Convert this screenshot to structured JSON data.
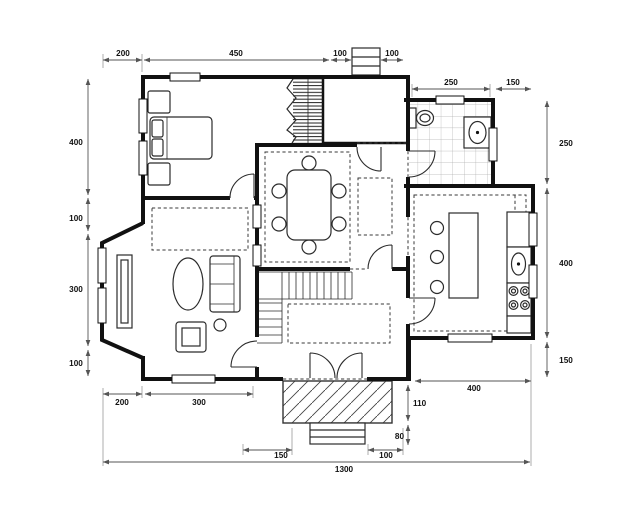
{
  "colors": {
    "background": "#ffffff",
    "walls": "#111111",
    "furniture_lines": "#2b2b2b",
    "dimension_lines": "#555555",
    "dimension_text": "#111111"
  },
  "dims": {
    "top": [
      "200",
      "450",
      "100",
      "100"
    ],
    "upper_right": [
      "250",
      "150"
    ],
    "right": [
      "250",
      "400",
      "150"
    ],
    "left": [
      "400",
      "100",
      "300",
      "100"
    ],
    "bottom_left": [
      "200",
      "300"
    ],
    "bottom_right": [
      "400"
    ],
    "porch": [
      "110",
      "80",
      "150",
      "100"
    ],
    "total": "1300"
  }
}
